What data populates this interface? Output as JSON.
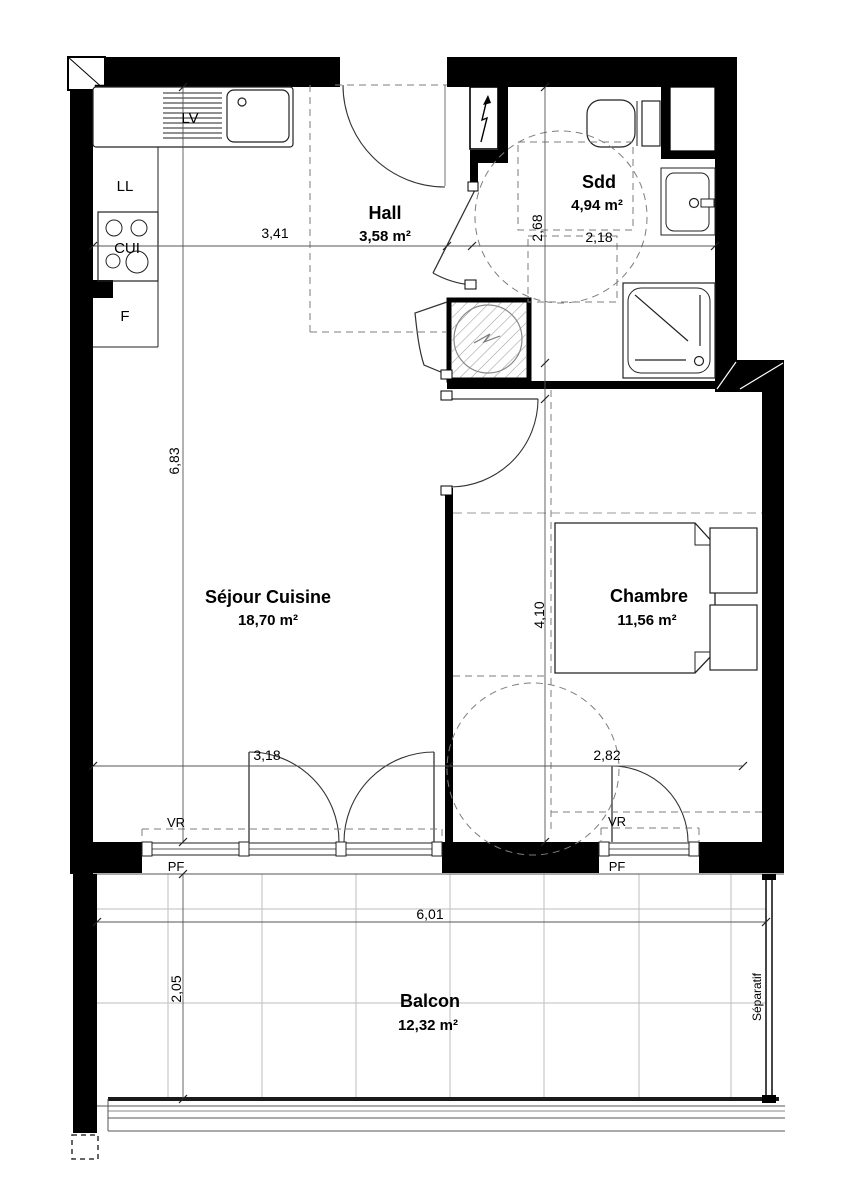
{
  "rooms": {
    "hall": {
      "name": "Hall",
      "area": "3,58 m²"
    },
    "sdd": {
      "name": "Sdd",
      "area": "4,94 m²"
    },
    "sejour": {
      "name": "Séjour Cuisine",
      "area": "18,70 m²"
    },
    "chambre": {
      "name": "Chambre",
      "area": "11,56 m²"
    },
    "balcon": {
      "name": "Balcon",
      "area": "12,32 m²"
    }
  },
  "appliances": {
    "dishwasher": "LV",
    "washing_machine": "LL",
    "hob": "CUI",
    "fridge": "F"
  },
  "openings": {
    "roller_shutter": "VR",
    "french_window": "PF",
    "separator": "Séparatif"
  },
  "dimensions": {
    "sejour_width": "3,41",
    "sdd_depth": "2,68",
    "sdd_width": "2,18",
    "sejour_depth": "6,83",
    "chambre_depth": "4,10",
    "sejour_bottom_width": "3,18",
    "chambre_width": "2,82",
    "balcon_width": "6,01",
    "balcon_depth": "2,05"
  },
  "colors": {
    "wall": "#000000",
    "fixture_line": "#222222",
    "dashed_line": "#7d7d7d",
    "tile_line": "#bdbdbd",
    "background": "#ffffff"
  }
}
